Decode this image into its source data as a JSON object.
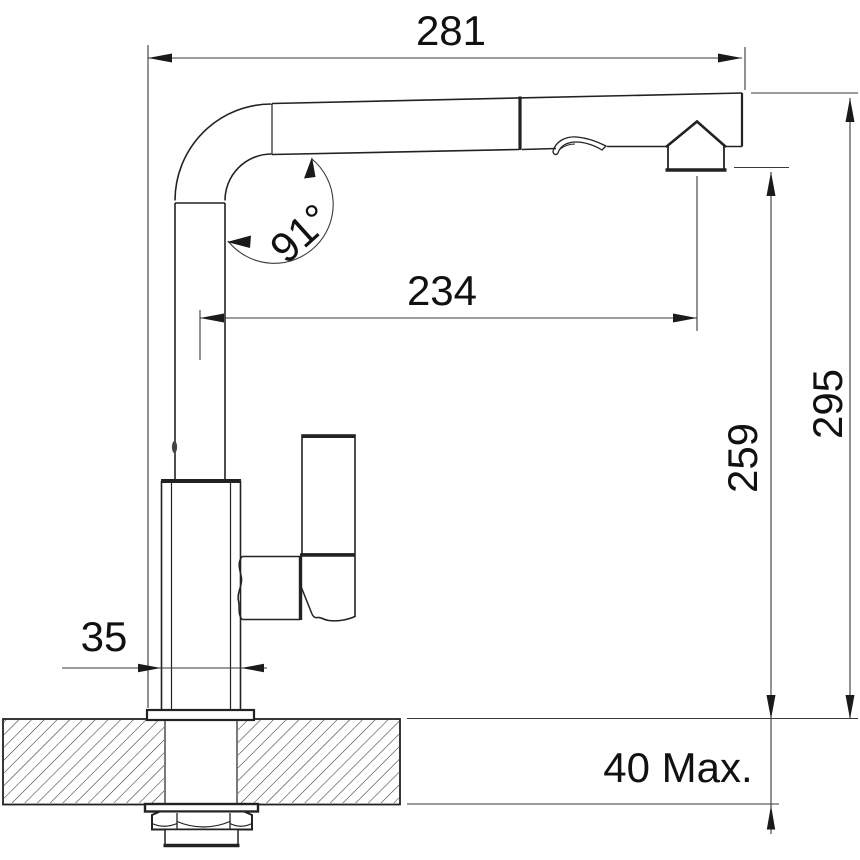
{
  "diagram": {
    "type": "technical-drawing",
    "dimensions": {
      "overall_reach": "281",
      "swivel_angle": "91°",
      "spout_reach": "234",
      "outlet_height": "259",
      "overall_height": "295",
      "body_width": "35",
      "deck_thickness_max": "40 Max."
    },
    "colors": {
      "background": "#ffffff",
      "line": "#222222",
      "dimension_line": "#3a3a3a"
    }
  }
}
